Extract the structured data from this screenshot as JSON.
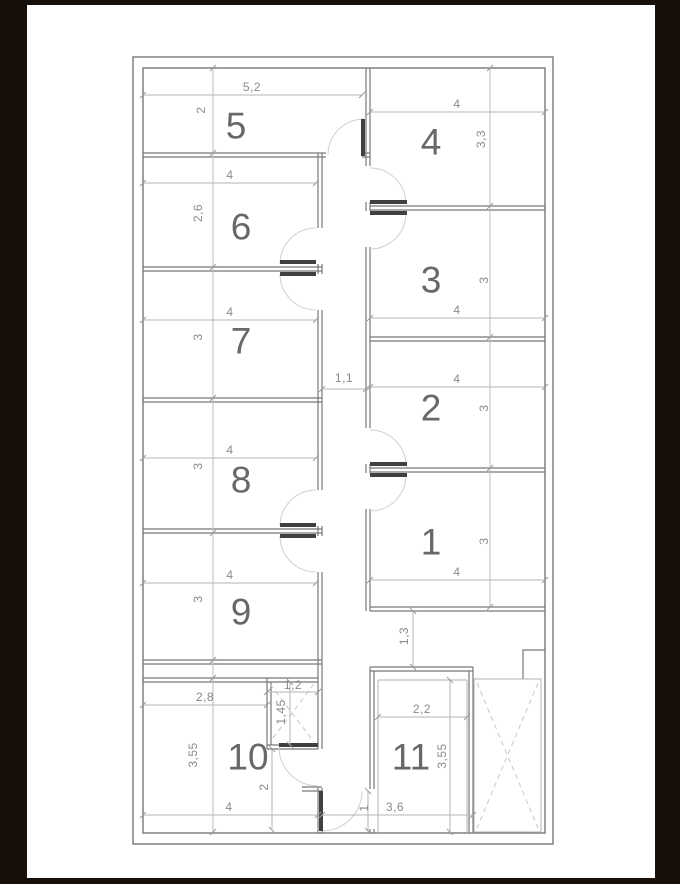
{
  "drawing_type": "floor-plan",
  "units_note": "dimensions in meters as drawn",
  "colors": {
    "background": "#170f09",
    "paper": "#ffffff",
    "wall": "#787878",
    "dimension_line": "#b4b4b4",
    "dimension_text": "#8a8a8a",
    "room_number_text": "#686868",
    "door_leaf": "#404040",
    "door_arc": "#cfcfcf"
  },
  "rooms": [
    {
      "number": "1",
      "width": "4",
      "height": "3"
    },
    {
      "number": "2",
      "width": "4",
      "height": "3"
    },
    {
      "number": "3",
      "width": "4",
      "height": "3"
    },
    {
      "number": "4",
      "width": "4",
      "height": "3,3"
    },
    {
      "number": "5",
      "width": "5,2",
      "height": "2"
    },
    {
      "number": "6",
      "width": "4",
      "height": "2,6"
    },
    {
      "number": "7",
      "width": "4",
      "height": "3"
    },
    {
      "number": "8",
      "width": "4",
      "height": "3"
    },
    {
      "number": "9",
      "width": "4",
      "height": "3"
    },
    {
      "number": "10",
      "width_top": "2,8",
      "width_bottom": "4",
      "height": "3,55",
      "height_right": "2"
    },
    {
      "number": "11",
      "width_top": "2,2",
      "width_bottom": "3,6",
      "height": "3,55"
    }
  ],
  "passages": {
    "corridor_width": "1,1",
    "hallway_width": "1,3",
    "entry_depth": "1"
  },
  "shaft": {
    "width": "1,2",
    "depth": "1,45"
  }
}
